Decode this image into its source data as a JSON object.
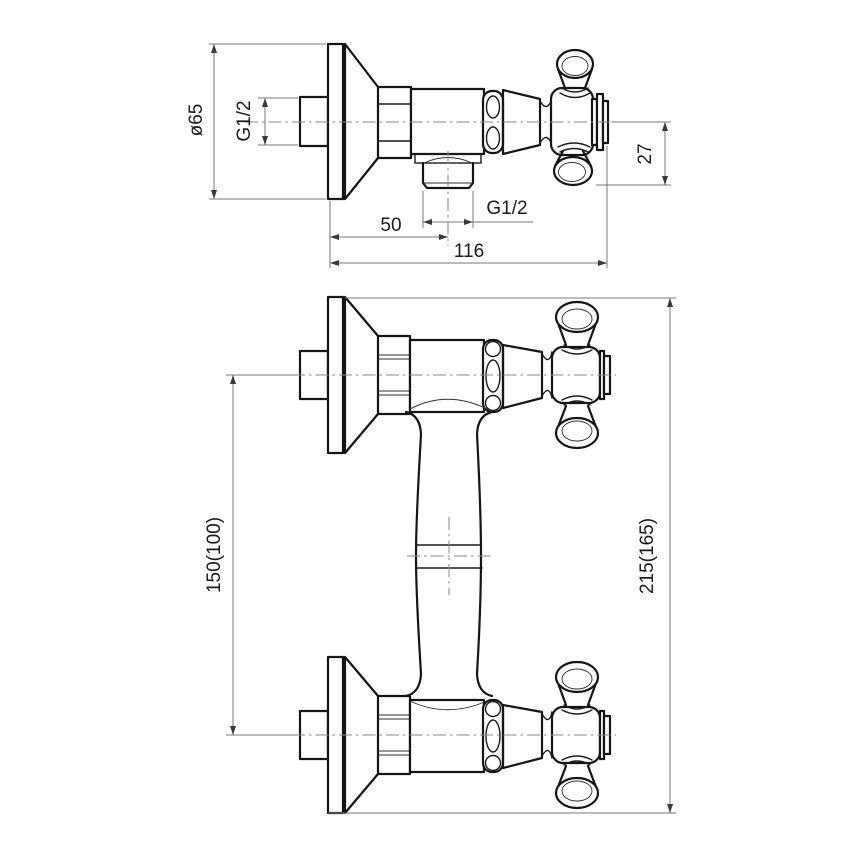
{
  "page": {
    "background": "#ffffff"
  },
  "drawing": {
    "kind": "technical dimension drawing",
    "subject": "wall-mounted shower mixer valve, side view (top) and front view (bottom)",
    "line_color": "#151515",
    "dimension_line_color": "#7a7a7a",
    "views": {
      "side_view": {
        "dimensions": {
          "flange_diameter": "ø65",
          "inlet_thread": "G1/2",
          "outlet_thread": "G1/2",
          "handle_offset": "27",
          "outlet_center_distance": "50",
          "overall_depth": "116"
        }
      },
      "front_view": {
        "dimensions": {
          "connection_centers": "150(100)",
          "overall_height": "215(165)"
        }
      }
    }
  }
}
